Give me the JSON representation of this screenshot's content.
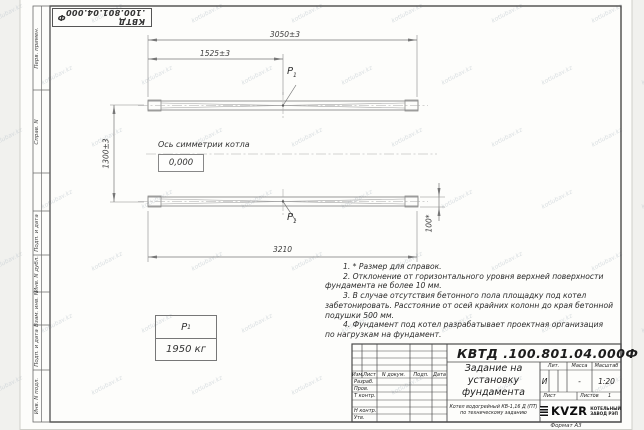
{
  "page": {
    "format_label": "Формат А3",
    "watermark": "kotlubav.kz"
  },
  "doc": {
    "number": "КВТД .100.801.04.000",
    "suffix": "Ф"
  },
  "side_strip": {
    "labels": [
      "Перв. примен.",
      "Справ. N",
      "Подп. и дата",
      "Инв. N дубл.",
      "Взам. инв. N",
      "Подп. и дата",
      "Инв. N подл."
    ]
  },
  "drawing": {
    "dims": {
      "width_total": "3050±3",
      "width_half": "1525±3",
      "height_between": "1300±3",
      "length_bottom": "3210",
      "beam_height": "100*"
    },
    "axis_label": "Ось симметрии котла",
    "level_mark": "0,000",
    "load_point": {
      "label": "P",
      "sub": "1"
    },
    "load_table": {
      "value": "1950 кг"
    }
  },
  "notes": {
    "lines": [
      "1. * Размер для справок.",
      "2. Отклонение от горизонтального уровня верхней поверхности",
      "фундамента не более 10 мм.",
      "3. В случае отсутствия бетонного пола площадку под котел",
      "забетонировать. Расстояние от осей крайних колонн до края бетонной",
      "подушки 500 мм.",
      "4. Фундамент под котел разрабатывает проектная организация",
      "по нагрузкам на фундамент."
    ]
  },
  "title_block": {
    "header_cols": [
      "Изм.",
      "Лист",
      "N докум.",
      "Подп.",
      "Дата"
    ],
    "rows": [
      "Разраб.",
      "Пров.",
      "Т контр.",
      "Н контр.",
      "Утв."
    ],
    "title_lines": [
      "Задание на",
      "установку",
      "фундамента"
    ],
    "subtitle_lines": [
      "Котел водогрейный КВ-1,16 Д (ПТ)",
      "по техническому заданию"
    ],
    "lit_label": "Лит.",
    "mass_label": "Масса",
    "scale_label": "Масштаб",
    "lit_value": "И",
    "mass_value": "-",
    "scale_value": "1:20",
    "sheet_label": "Лист",
    "sheets_label": "Листов",
    "sheets_value": "1",
    "logo_text": "KVZR",
    "company_lines": [
      "КОТЕЛЬНЫЙ",
      "ЗАВОД РЭП"
    ]
  }
}
